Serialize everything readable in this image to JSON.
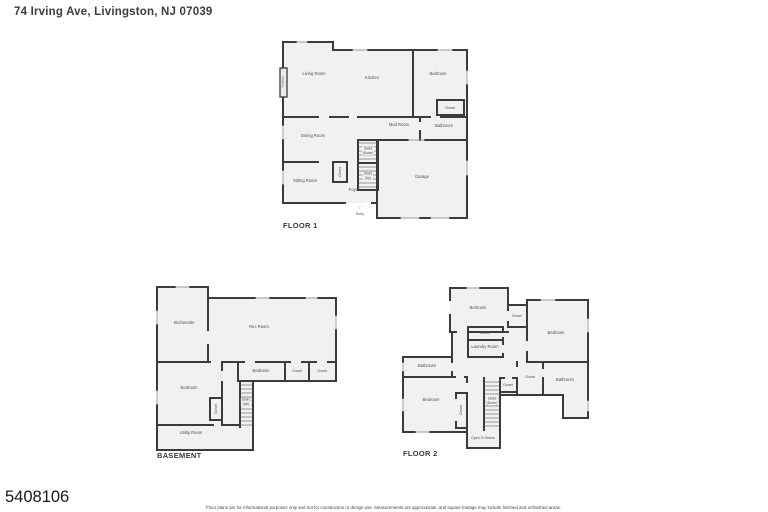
{
  "header": {
    "title": "74 Irving Ave, Livingston, NJ 07039"
  },
  "footer": {
    "photo_id": "5408106",
    "disclaimer": "Floor plans are for informational purposes only and not for construction or design use. Measurements are approximate, and square footage may include finished and unfinished areas."
  },
  "colors": {
    "wall": "#3b3b3b",
    "room_fill": "#f1f1f1",
    "label": "#4d4d4d"
  },
  "floor1": {
    "name": "FLOOR 1",
    "rooms": {
      "living_room": "Living Room",
      "kitchen": "Kitchen",
      "bedroom": "Bedroom",
      "bedroom_closet": "Closet",
      "mud_room": "Mud Room",
      "bathroom": "Bathroom",
      "dining_room": "Dining Room",
      "stairs_down": "Stairs\n(Down)",
      "stairs_up": "Stairs\n(Up)",
      "hall_closet": "Closet",
      "sitting_room": "Sitting Room",
      "foyer": "Foyer",
      "garage": "Garage",
      "entry": "Entry",
      "entry_arrow": "↑",
      "fireplace": "Fireplace"
    }
  },
  "basement": {
    "name": "BASEMENT",
    "rooms": {
      "kitchenette": "Kitchenette",
      "rec_room": "Rec Room",
      "bedroom_center": "Bedroom",
      "closet_a": "Closet",
      "closet_b": "Closet",
      "bedroom_left": "Bedroom",
      "bedroom_closet": "Closet",
      "stairs_up": "Stairs\n(Up)",
      "utility_room": "Utility Room"
    }
  },
  "floor2": {
    "name": "FLOOR 2",
    "rooms": {
      "bedroom_top_left": "Bedroom",
      "closet_top": "Closet",
      "bedroom_top_right": "Bedroom",
      "closet_middle": "Closet",
      "laundry_room": "Laundry Room",
      "bathroom_left": "Bathroom",
      "bedroom_bottom_left": "Bedroom",
      "bedroom_closet": "Closet",
      "stairs_down": "Stairs\n(Down)",
      "closet_center": "Closet",
      "closet_right": "Closet",
      "bathroom_right": "Bathroom",
      "open_to_below": "Open To Below"
    }
  }
}
